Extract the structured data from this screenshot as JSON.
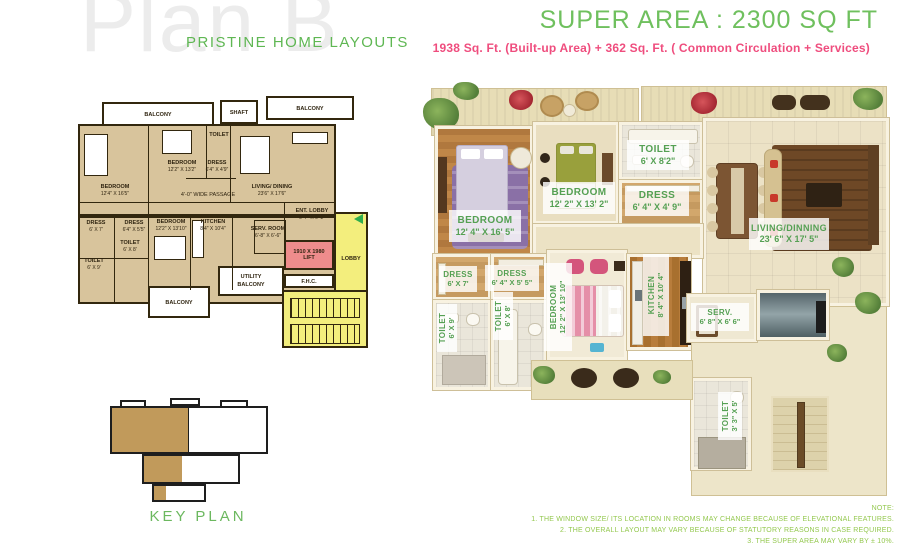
{
  "page": {
    "watermark": "Plan B",
    "brand": "PRISTINE HOME LAYOUTS",
    "super_area": "SUPER AREA : 2300  SQ FT",
    "area_breakup": "1938 Sq. Ft. (Built-up Area) + 362 Sq. Ft. ( Common Circulation + Services)",
    "key_plan": "KEY PLAN"
  },
  "colors": {
    "brand_green": "#5fb753",
    "heading_green": "#6fc05e",
    "pink": "#ef4d7e",
    "plan_tan": "#d8c49c",
    "lobby_yellow": "#f3ee7d",
    "lift_pink": "#ee8c8c",
    "label_green": "#55a053",
    "note_green": "#94c84f"
  },
  "bw_plan": {
    "balcony_left": "BALCONY",
    "shaft": "SHAFT",
    "balcony_right": "BALCONY",
    "rooms": {
      "bedroom1": {
        "name": "BEDROOM",
        "dims": "12'4\" X 16'5\""
      },
      "bedroom2": {
        "name": "BEDROOM",
        "dims": "12'2\" X 13'2\""
      },
      "dress_top": {
        "name": "DRESS",
        "dims": "6'4\" X 4'9\""
      },
      "toilet_top": {
        "name": "TOILET",
        "dims": "6' X 8'2\""
      },
      "living": {
        "name": "LIVING/ DINING",
        "dims": "23'6\" X 17'6\""
      },
      "ent_lobby": {
        "name": "ENT. LOBBY",
        "dims": "6'-7\" X 6'-2\""
      },
      "dress1": {
        "name": "DRESS",
        "dims": "6' X 7'"
      },
      "dress2": {
        "name": "DRESS",
        "dims": "6'4\" X 5'5\""
      },
      "bedroom3": {
        "name": "BEDROOM",
        "dims": "12'2\" X 13'10\""
      },
      "kitchen": {
        "name": "KITCHEN",
        "dims": "8'4\" X 10'4\""
      },
      "toilet1": {
        "name": "TOILET",
        "dims": "6' X 9'"
      },
      "toilet2": {
        "name": "TOILET",
        "dims": "6' X 8'"
      },
      "serv_room": {
        "name": "SERV. ROOM",
        "dims": "6'-8\" X 6'-6\""
      }
    },
    "passage": "4'-0\" WIDE PASSAGE",
    "lift_size": "1910 X 1980",
    "lift": "LIFT",
    "lobby": "LOBBY",
    "fhc": "F.H.C.",
    "utility_line1": "UTILITY",
    "utility_line2": "BALCONY",
    "balcony_bottom": "BALCONY"
  },
  "color_plan": {
    "rooms": {
      "bedroom1": {
        "name": "BEDROOM",
        "dims": "12' 4\" X 16' 5\""
      },
      "bedroom2": {
        "name": "BEDROOM",
        "dims": "12' 2\" X 13' 2\""
      },
      "toilet_top": {
        "name": "TOILET",
        "dims": "6' X 8'2\""
      },
      "dress_top": {
        "name": "DRESS",
        "dims": "6' 4\" X 4' 9\""
      },
      "living": {
        "name": "LIVING/DINNING",
        "dims": "23' 6\" X 17' 5\""
      },
      "dress1": {
        "name": "DRESS",
        "dims": "6' X 7'"
      },
      "dress2": {
        "name": "DRESS",
        "dims": "6' 4\" X 5' 5\""
      },
      "toilet1": {
        "name": "TOILET",
        "dims": "6' X 9'"
      },
      "toilet2": {
        "name": "TOILET",
        "dims": "6' X 8'"
      },
      "bedroom3": {
        "name": "BEDROOM",
        "dims": "12' 2\" X 13' 10\""
      },
      "kitchen": {
        "name": "KITCHEN",
        "dims": "8' 4\" X 10' 4\""
      },
      "serv": {
        "name": "SERV.",
        "dims": "6' 8\" X 6' 6\""
      },
      "toilet3": {
        "name": "TOILET",
        "dims": "3' 3\" X 5'"
      }
    }
  },
  "notes": {
    "title": "NOTE:",
    "l1": "1. THE WINDOW SIZE/ ITS LOCATION IN ROOMS MAY CHANGE BECAUSE OF ELEVATIONAL FEATURES.",
    "l2": "2. THE OVERALL LAYOUT MAY VARY BECAUSE OF STATUTORY REASONS IN CASE REQUIRED.",
    "l3": "3. THE SUPER AREA MAY VARY BY ± 10%.",
    "l4": "4. CURRENTLY NO COLUMNS ARE SHOWN IN THE PLAN WHICH WILL BE INCORPORATED AS/ STRUCTURE."
  }
}
